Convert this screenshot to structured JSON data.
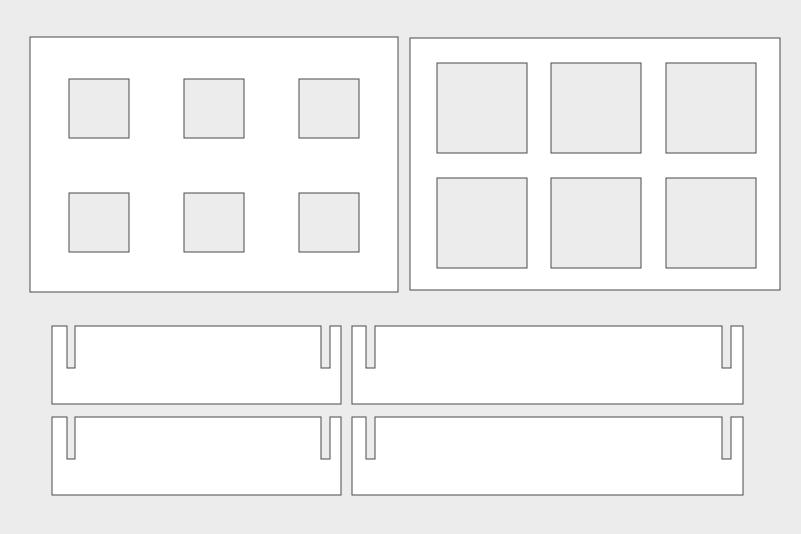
{
  "canvas": {
    "width": 801,
    "height": 534,
    "background_color": "#ececec"
  },
  "style": {
    "part_fill": "#ffffff",
    "hole_fill": "#ececec",
    "stroke_color": "#4a4a4a",
    "stroke_width": 1
  },
  "panels": [
    {
      "name": "hole-panel-left",
      "x": 30,
      "y": 37,
      "width": 368,
      "height": 255,
      "hole_width": 60,
      "hole_height": 59,
      "holes": [
        {
          "x": 69,
          "y": 79
        },
        {
          "x": 184,
          "y": 79
        },
        {
          "x": 299,
          "y": 79
        },
        {
          "x": 69,
          "y": 193
        },
        {
          "x": 184,
          "y": 193
        },
        {
          "x": 299,
          "y": 193
        }
      ]
    },
    {
      "name": "hole-panel-right",
      "x": 410,
      "y": 38,
      "width": 370,
      "height": 252,
      "hole_width": 90,
      "hole_height": 90,
      "holes": [
        {
          "x": 437,
          "y": 63
        },
        {
          "x": 551,
          "y": 63
        },
        {
          "x": 666,
          "y": 63
        },
        {
          "x": 437,
          "y": 178
        },
        {
          "x": 551,
          "y": 178
        },
        {
          "x": 666,
          "y": 178
        }
      ]
    }
  ],
  "bars": [
    {
      "name": "slotted-bar-top-left",
      "x": 52,
      "y": 326,
      "width": 289,
      "height": 78,
      "slots": [
        {
          "offset": 15,
          "width": 8,
          "depth": 42
        },
        {
          "offset": 269,
          "width": 9,
          "depth": 42
        }
      ]
    },
    {
      "name": "slotted-bar-bottom-left",
      "x": 52,
      "y": 417,
      "width": 289,
      "height": 78,
      "slots": [
        {
          "offset": 15,
          "width": 8,
          "depth": 42
        },
        {
          "offset": 269,
          "width": 9,
          "depth": 42
        }
      ]
    },
    {
      "name": "slotted-bar-top-right",
      "x": 352,
      "y": 326,
      "width": 391,
      "height": 78,
      "slots": [
        {
          "offset": 14,
          "width": 9,
          "depth": 42
        },
        {
          "offset": 370,
          "width": 9,
          "depth": 42
        }
      ]
    },
    {
      "name": "slotted-bar-bottom-right",
      "x": 352,
      "y": 417,
      "width": 391,
      "height": 78,
      "slots": [
        {
          "offset": 14,
          "width": 9,
          "depth": 42
        },
        {
          "offset": 370,
          "width": 9,
          "depth": 42
        }
      ]
    }
  ]
}
